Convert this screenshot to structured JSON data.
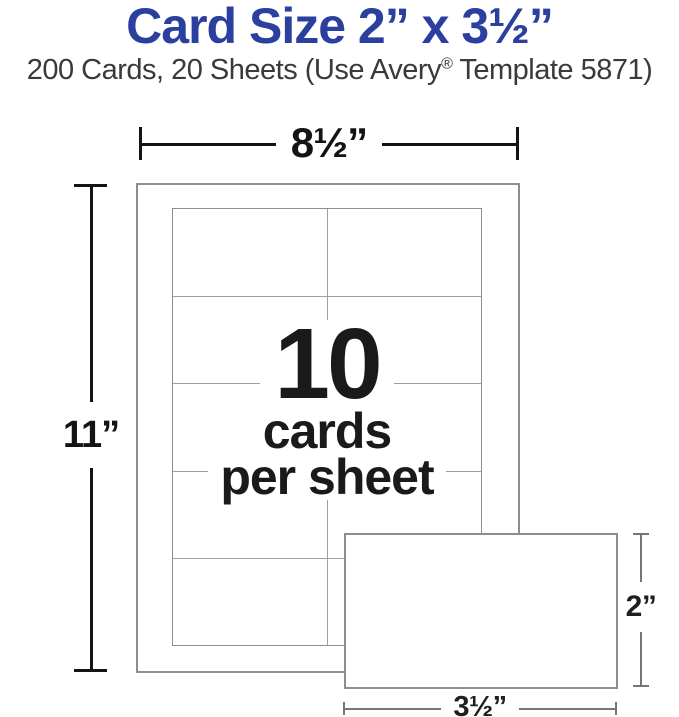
{
  "header": {
    "title": "Card Size 2” x 3½”",
    "subtitle_pre": "200 Cards, 20 Sheets (Use Avery",
    "subtitle_reg": "®",
    "subtitle_post": " Template 5871)"
  },
  "diagram": {
    "sheet": {
      "width_label": "8½”",
      "height_label": "11”"
    },
    "grid": {
      "rows": 5,
      "cols": 2
    },
    "center": {
      "count": "10",
      "line1": "cards",
      "line2": "per sheet"
    },
    "card": {
      "width_label": "3½”",
      "height_label": "2”"
    }
  },
  "colors": {
    "title-blue": "#2b3f9e",
    "subtitle-gray": "#3a3a3a",
    "dim-black": "#141414",
    "outline-gray": "#8d8d8d",
    "grid-line-gray": "#9e9e9e",
    "thin-dim-gray": "#767676",
    "label-dark": "#1f1f1f",
    "count-black": "#1a1a1a"
  }
}
